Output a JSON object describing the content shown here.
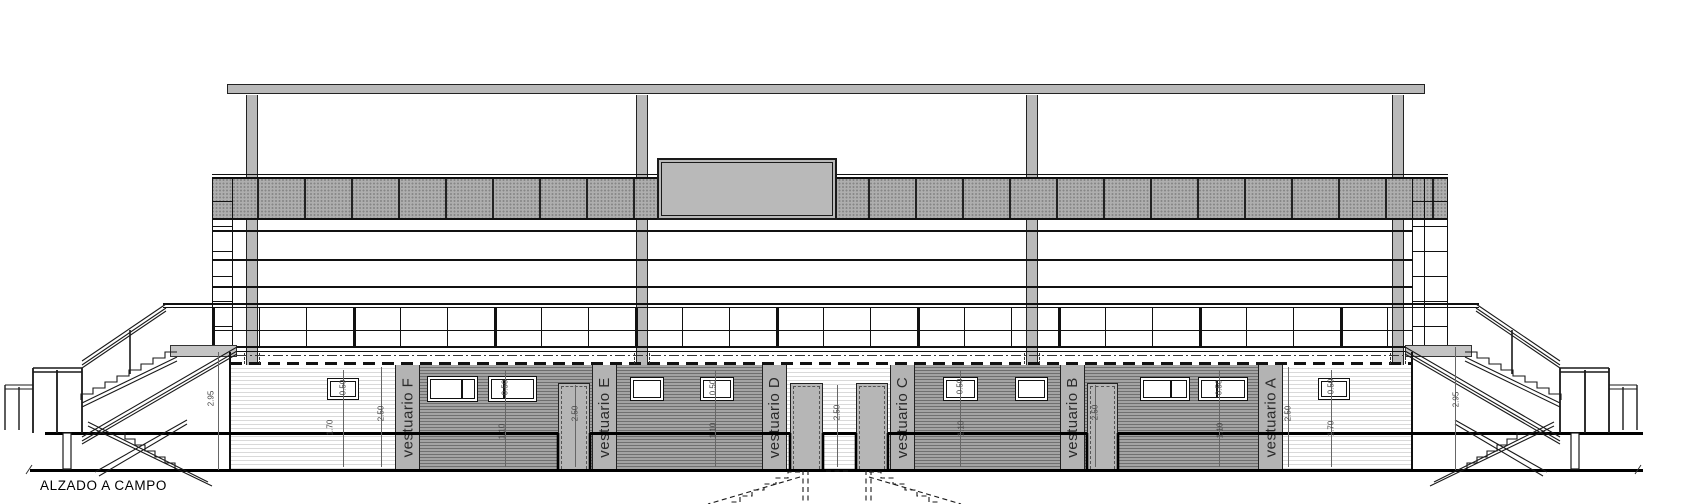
{
  "title": "ALZADO A CAMPO",
  "rooms": [
    {
      "label": "vestuario F"
    },
    {
      "label": "vestuario E"
    },
    {
      "label": "vestuario D"
    },
    {
      "label": "vestuario C"
    },
    {
      "label": "vestuario B"
    },
    {
      "label": "vestuario A"
    }
  ],
  "dimensions": [
    "2.95",
    "0.50",
    "1.70",
    "2.50",
    "0.50",
    "1.10",
    "2.50",
    "0.50",
    "1.10",
    "2.50",
    "0.50",
    "1.10",
    "2.50",
    "0.50",
    "1.10",
    "2.50",
    "0.50",
    "1.70",
    "2.95"
  ],
  "colors": {
    "line": "#1a1a1a",
    "concrete": "#b9b9b9",
    "wall_dark_base": "#a3a3a3",
    "wall_dark_stripe": "#6f6f6f",
    "wall_light_stripe": "#d9d9d9",
    "pilaster": "#b3b3b3",
    "door": "#b6b6b6",
    "mesh": "#aeaeae"
  }
}
